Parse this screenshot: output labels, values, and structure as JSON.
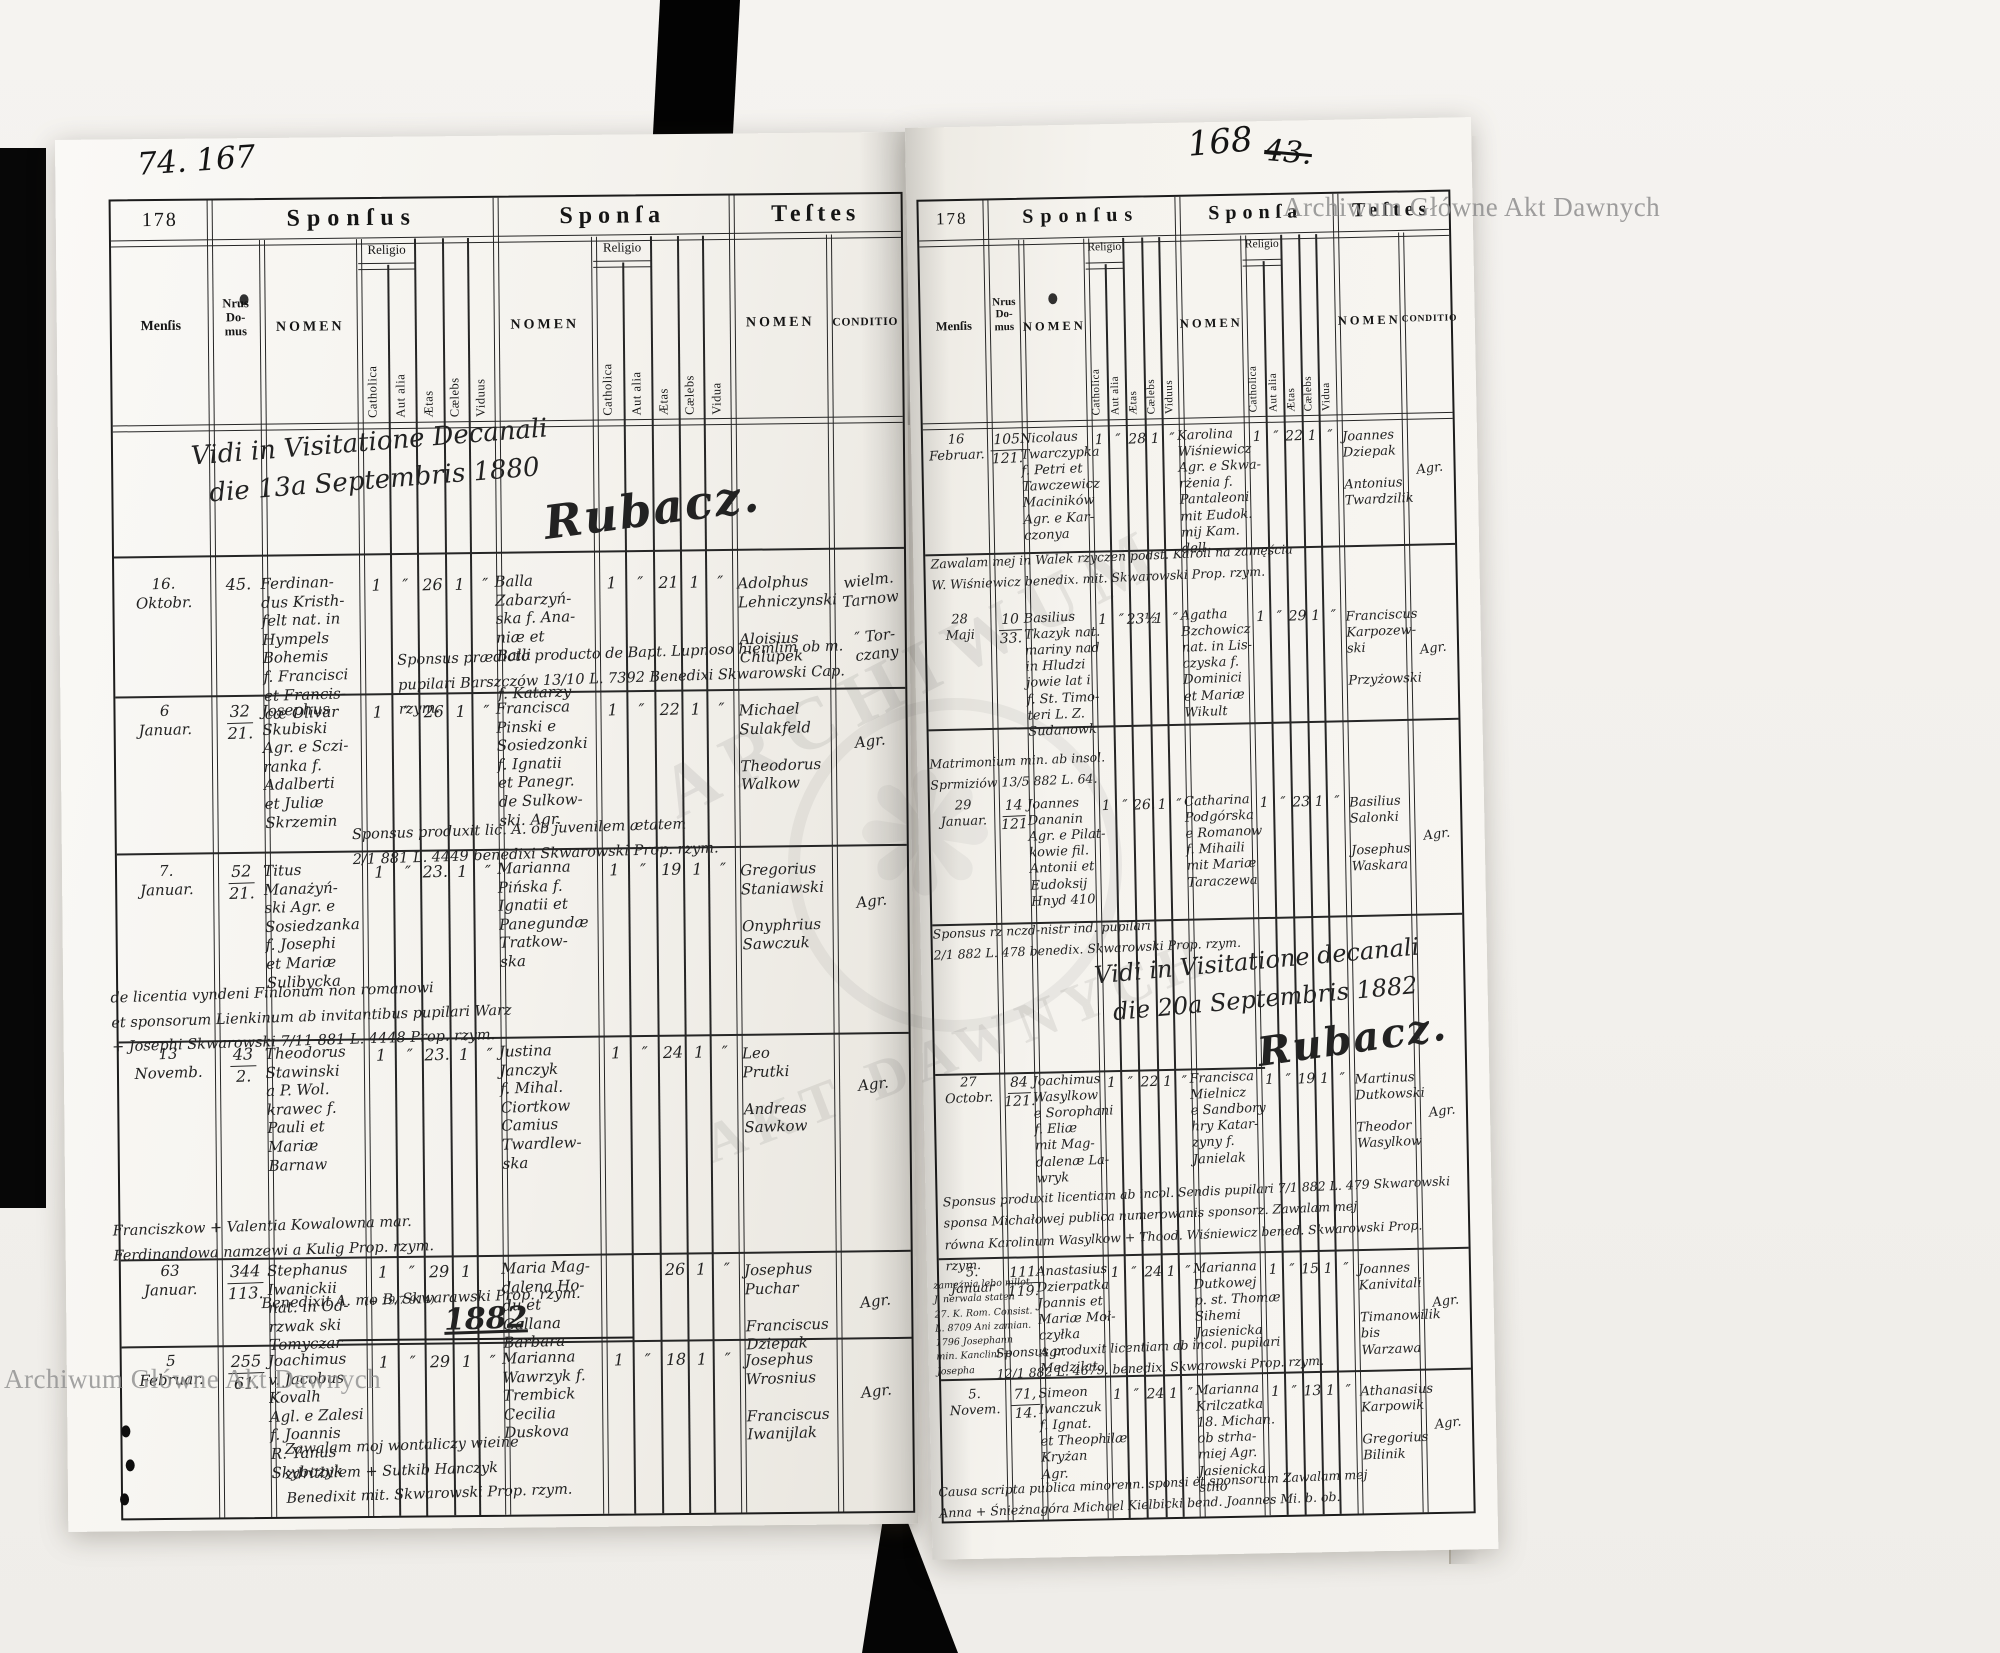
{
  "document": {
    "watermark": "Archiwum Główne Akt Dawnych",
    "seal_top": "ARCHIWUM",
    "seal_bottom": "AKT DAWNYCH",
    "left_folio": "74. 167",
    "right_folio": "168",
    "right_folio_struck": "43."
  },
  "form_labels": {
    "form_number": "178",
    "sponsus": "Sponſus",
    "sponsa": "Sponſa",
    "testes": "Teſtes",
    "mensis": "Menſis",
    "nrus_domus": "Nrus\nDo-\nmus",
    "nomen": "NOMEN",
    "religio": "Religio",
    "catholica": "Catholica",
    "aut_alia": "Aut alia",
    "aetas": "Ætas",
    "caelebs": "Cælebs",
    "viduus": "Viduus",
    "vidua": "Vidua",
    "conditio": "CONDITIO"
  },
  "left_page": {
    "visitation": {
      "line1": "Vidi in Visitatione Decanali",
      "line2": "die 13a Septembris 1880",
      "signature": "Rubacz."
    },
    "year_divider": "1882",
    "rows": [
      {
        "mensis": "16.\nOktobr.",
        "domus_top": "45.",
        "domus_bottom": "",
        "sponsus": "Ferdinan-\ndus Kristh-\nfelt nat. in\nHympels\nBohemis\nf. Francisci\net Francis-\ncæ Olivar",
        "s_marks": [
          "1",
          "″",
          "26",
          "1",
          "″"
        ],
        "sponsa": "Balla\nZabarzyń-\nska f. Ana-\nniæ et\nBalli\n\nf. Katarzy",
        "p_marks": [
          "1",
          "″",
          "21",
          "1",
          "″"
        ],
        "testes": "Adolphus\nLehniczynski\n\nAloisius\nChlupek",
        "conditio": "wielm.\nTarnow\n\n″ Tor-\nczany",
        "aside": ""
      },
      {
        "mensis": "6\nJanuar.",
        "domus_top": "32",
        "domus_bottom": "21.",
        "sponsus": "Josephus\nSkubiski\nAgr. e Sczi-\nranka f.\nAdalberti\net Juliæ\nSkrzemin",
        "s_marks": [
          "1",
          "″",
          "26",
          "1",
          "″"
        ],
        "sponsa": "Francisca\nPinski e\nSosiedzonki\nf. Ignatii\net Panegr.\nde Sulkow-\nski. Agr.",
        "p_marks": [
          "1",
          "″",
          "22",
          "1",
          "″"
        ],
        "testes": "Michael\nSulakfeld\n\nTheodorus\nWalkow",
        "conditio": "Agr.",
        "aside": ""
      },
      {
        "mensis": "7.\nJanuar.",
        "domus_top": "52",
        "domus_bottom": "21.",
        "sponsus": "Titus\nManażyń-\nski Agr. e\nSosiedzanka\nf. Josephi\net Mariæ\nSulibycka",
        "s_marks": [
          "1",
          "″",
          "23.",
          "1",
          "″"
        ],
        "sponsa": "Marianna\nPińska f.\nIgnatii et\nPanegundæ\nTratkow-\nska",
        "p_marks": [
          "1",
          "″",
          "19",
          "1",
          "″"
        ],
        "testes": "Gregorius\nStaniawski\n\nOnyphrius\nSawczuk",
        "conditio": "Agr.",
        "aside": ""
      },
      {
        "mensis": "13\nNovemb.",
        "domus_top": "43",
        "domus_bottom": "2.",
        "sponsus": "Theodorus\nStawinski\na P. Wol.\nkrawec f.\nPauli et\nMariæ\nBarnaw",
        "s_marks": [
          "1",
          "″",
          "23.",
          "1",
          "″"
        ],
        "sponsa": "Justina\nJanczyk\nf. Mihal.\nCiortkow\nCamius\nTwardlew-\nska",
        "p_marks": [
          "1",
          "″",
          "24",
          "1",
          "″"
        ],
        "testes": "Leo\nPrutki\n\nAndreas\nSawkow",
        "conditio": "Agr.",
        "aside": ""
      },
      {
        "mensis": "63\nJanuar.",
        "domus_top": "344",
        "domus_bottom": "113.",
        "sponsus": "Stephanus\nIwanickii\nnat. in Od-\nrzwak ski\nTomyczar",
        "s_marks": [
          "1",
          "″",
          "29",
          "1",
          ""
        ],
        "sponsa": "Maria Mag-\ndalena Ho-\ndu et\nGallana\nBarbara",
        "p_marks": [
          "",
          "",
          "26",
          "1",
          "″"
        ],
        "testes": "Josephus\nPuchar\n\nFranciscus\nDziepak",
        "conditio": "Agr.",
        "aside": "(+ 19/7 914)"
      },
      {
        "mensis": "5\nFebruar.",
        "domus_top": "255",
        "domus_bottom": "61.",
        "sponsus": "Joachimus\nv. Jacobus\nKovalh\nAgl. e Zalesi\nf. Joannis\nR. Yanus\nSkybczyk",
        "s_marks": [
          "1",
          "″",
          "29",
          "1",
          "″"
        ],
        "sponsa": "Marianna\nWawrzyk f.\nTrembick\nCecilia\nDuskova",
        "p_marks": [
          "1",
          "″",
          "18",
          "1",
          "″"
        ],
        "testes": "Josephus\nWrosnius\n\nFranciscus\nIwanijlak",
        "conditio": "Agr.",
        "aside": ""
      }
    ],
    "notes": [
      "Sponsus prædicto producto de Bapt. Lupnoso hiemlim ob m.\npupilari Barszczów 13/10 L. 7392 Benedixi Skwarowski Cap. rzym.",
      "Sponsus produxit lic. A. ob juvenilem ætatem\n2/1 881 L. 4449 benedixi Skwarowski Prop. rzym.",
      "de licentia vyndeni Finlonum non romanowi\net sponsorum Lienkinum ab invitantibus pupilari Warz\n+ Josephi Skwarowski 7/11 881 L. 4448 Prop. rzym.",
      "Franciszkow + Valentia Kowalowna mar.\nFerdinandowa namzewi a Kulig Prop. rzym.",
      "Benedixit A. mo B. Skwarawski Prop. rzym.",
      "Zawalam moj wontaliczy wieine\nzdritbilem + Sutkib Hanczyk\nBenedixit mit. Skwarowski Prop. rzym."
    ]
  },
  "right_page": {
    "visitation": {
      "line1": "Vidi in Visitatione decanali",
      "line2": "die 20a Septembris 1882",
      "signature": "Rubacz."
    },
    "margin_note": "zamężnia lebo nillot.\nJ. nerwala staten\n27. K. Rom. Consist.\nL. 8709 Ani zamian.\n1796 Josephann\nmin. Kanclini + Josepha",
    "rows": [
      {
        "mensis": "16\nFebruar.",
        "domus_top": "105",
        "domus_bottom": "121.",
        "sponsus": "Nicolaus\nTwarczypka\nf. Petri et\nTawczewicz\nMaciników\nAgr. e Kar-\nczonya",
        "s_marks": [
          "1",
          "″",
          "28",
          "1",
          "″"
        ],
        "sponsa": "Karolina\nWiśniewicz\nAgr. e Skwa-\nrżenia f.\nPantaleoni\nmit Eudok.\nmij Kam.\ndell",
        "p_marks": [
          "1",
          "″",
          "22",
          "1",
          "″"
        ],
        "testes": "Joannes\nDziepak\n\nAntonius\nTwardzilik",
        "conditio": "Agr.",
        "aside": ""
      },
      {
        "mensis": "28\nMaji",
        "domus_top": "10",
        "domus_bottom": "33.",
        "sponsus": "Basilius\nTkazyk nat.\nmariny nad\nin Hludzi\njowie lat i\nf. St. Timo-\nteri L. Z.\nSudanowk",
        "s_marks": [
          "1",
          "″",
          "23½",
          "1",
          "″"
        ],
        "sponsa": "Agatha\nBzchowicz\nnat. in Lis-\nczyska f.\nDominici\net Mariæ\nWikult",
        "p_marks": [
          "1",
          "″",
          "29",
          "1",
          "″"
        ],
        "testes": "Franciscus\nKarpozew-\nski\n\nPrzyżowski",
        "conditio": "Agr.",
        "aside": ""
      },
      {
        "mensis": "29\nJanuar.",
        "domus_top": "14",
        "domus_bottom": "121",
        "sponsus": "Joannes\nDananin\nAgr. e Pilat-\nkowie fil.\nAntonii et\nEudoksij\nHnyd 410",
        "s_marks": [
          "1",
          "″",
          "26.",
          "1",
          "″"
        ],
        "sponsa": "Catharina\nPodgórska\ne Romanow\nf. Mihaili\nmit Mariæ\nTaraczewa",
        "p_marks": [
          "1",
          "″",
          "23",
          "1",
          "″"
        ],
        "testes": "Basilius\nSalonki\n\nJosephus\nWaskara",
        "conditio": "Agr.",
        "aside": ""
      },
      {
        "mensis": "27\nOctobr.",
        "domus_top": "84",
        "domus_bottom": "121.",
        "sponsus": "Joachimus\nWasylkow\ne Sorophani\nf. Eliæ\nmit Mag-\ndalenæ La-\nwryk",
        "s_marks": [
          "1",
          "″",
          "22",
          "1",
          "″"
        ],
        "sponsa": "Francisca\nMielnicz\ne Sandbory\nhry Katar-\nzyny f.\nJanielak",
        "p_marks": [
          "1",
          "″",
          "19",
          "1",
          "″"
        ],
        "testes": "Martinus\nDutkowski\n\nTheodor\nWasylkow",
        "conditio": "Agr.",
        "aside": ""
      },
      {
        "mensis": "5.\nJanuar",
        "domus_top": "111",
        "domus_bottom": "119.",
        "sponsus": "Anastasius\nDzierpatka\nJoannis et\nMariæ Moł-\nczyłka\nAgr.\nMedzilat.",
        "s_marks": [
          "1",
          "″",
          "24",
          "1",
          "″"
        ],
        "sponsa": "Marianna\nDutkowej\np. st. Thomæ\nSihemi\nJasienicka",
        "p_marks": [
          "1",
          "″",
          "15",
          "1",
          "″"
        ],
        "testes": "Joannes\nKanivitali\n\nTimanowilik\nbis Warzawa",
        "conditio": "Agr.",
        "aside": ""
      },
      {
        "mensis": "5. Novem.",
        "domus_top": "71,",
        "domus_bottom": "14.",
        "sponsus": "Simeon\nIwanczuk\nf. Ignat.\net Theophilæ\nKryżan\nAgr.",
        "s_marks": [
          "1",
          "″",
          "24",
          "1",
          "″"
        ],
        "sponsa": "Marianna\nKrilczatka\n18. Michan.\nob strha-\nmiej Agr.\nJasienicka\nstho",
        "p_marks": [
          "1",
          "″",
          "13",
          "1",
          "″"
        ],
        "testes": "Athanasius\nKarpowik\n\nGregorius\nBilinik",
        "conditio": "Agr.",
        "aside": ""
      }
    ],
    "notes": [
      "Zawalam mej in Walek rzyczen podst. Karoli na zamęścia\nW. Wiśniewicz benedix. mit. Skwarowski Prop. rzym.",
      "Matrimonium min. ab insol.\nSprmiziów 13/5 882 L. 64.",
      "Sponsus rz nczd-nistr ind. pupilari\n2/1 882 L. 478 benedix. Skwarowski Prop. rzym.",
      "Sponsus produxit licentiam ab incol. Sendis pupilari 7/1 882 L. 479 Skwarowski\nsponsa Michałowej publica numerowanis sponsorz. Zawalam mej\nrówna Karolinum Wasylkow + Thood. Wiśniewicz bened. Skwarowski Prop. rzym.",
      "Sponsus produxit licentiam ab incol. pupilari\n12/1 882 L. 4679. benedix. Skwarowski Prop. rzym.",
      "Causa scripta publica minorenn. sponsi et sponsorum Zawalam mej\nAnna + Śnieżnagóra Michael Kielbicki bend. Joannes Mi. b. ob."
    ]
  }
}
